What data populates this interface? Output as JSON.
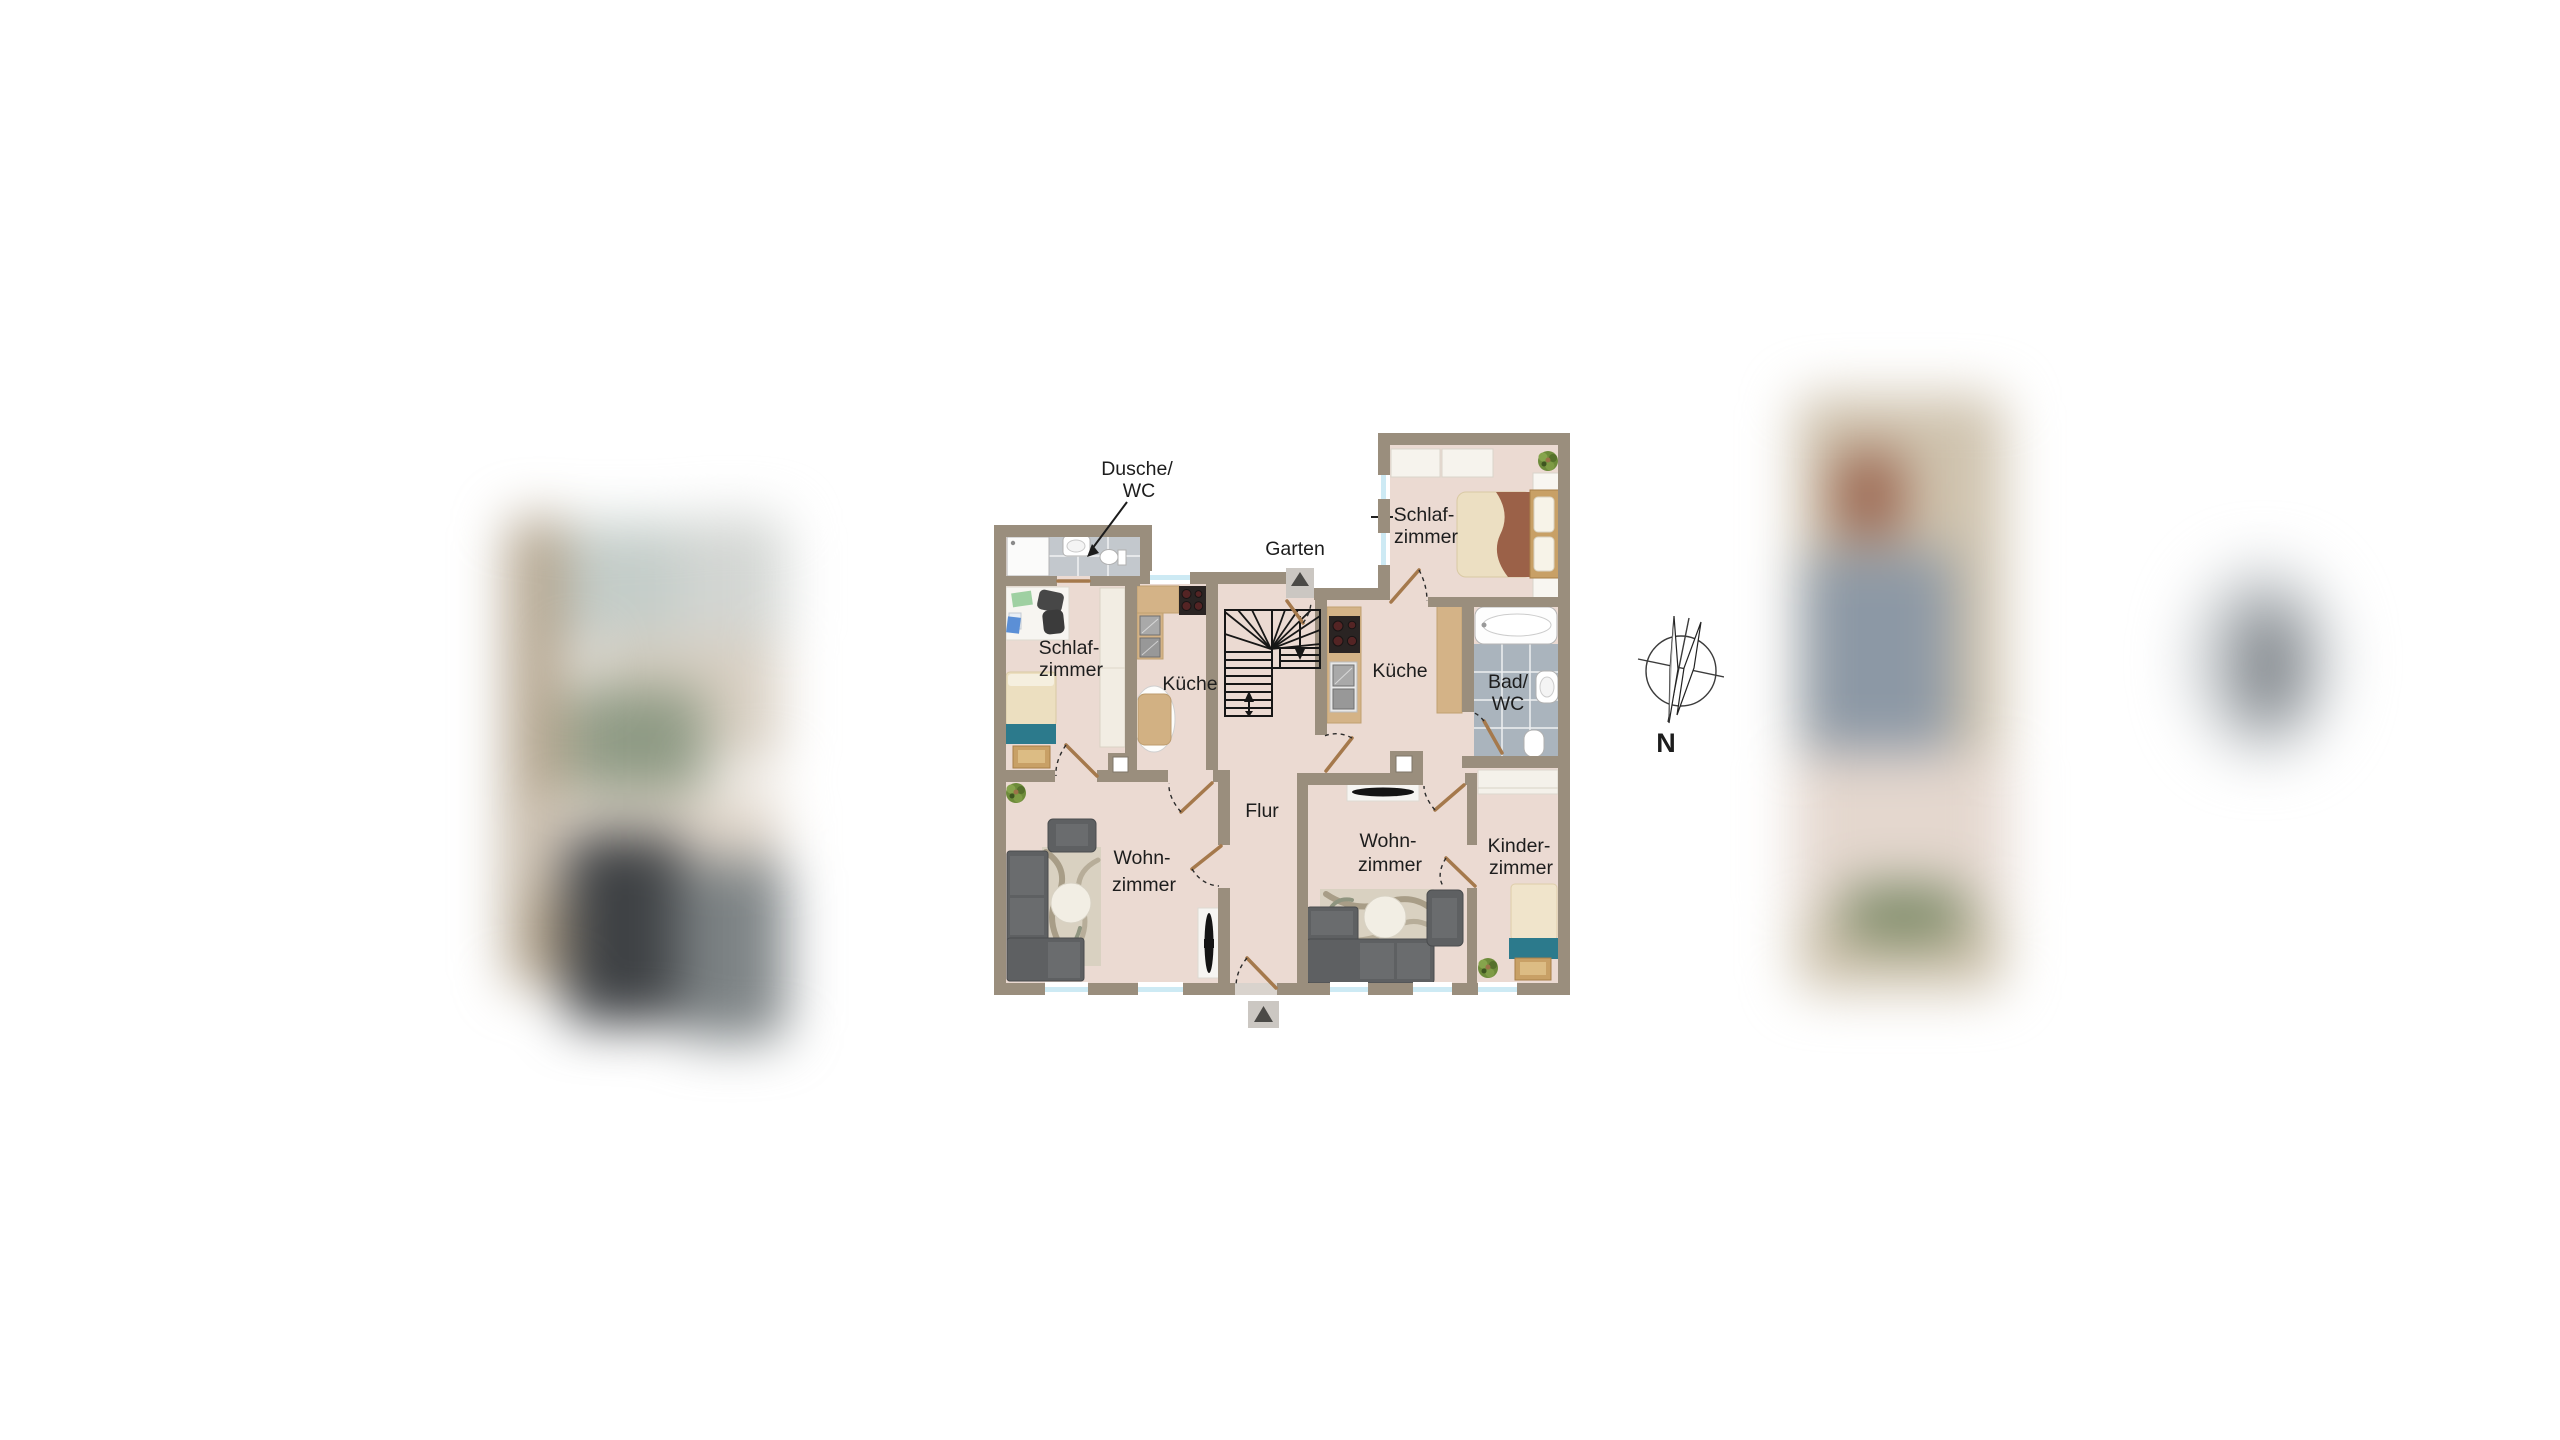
{
  "floorplan": {
    "garten_label": "Garten",
    "compass_label": "N",
    "rooms": {
      "dusche_wc": {
        "line1": "Dusche/",
        "line2": "WC"
      },
      "schlafzimmer_left": {
        "line1": "Schlaf-",
        "line2": "zimmer"
      },
      "schlafzimmer_right": {
        "line1": "Schlaf-",
        "line2": "zimmer"
      },
      "kueche_left": {
        "label": "Küche"
      },
      "kueche_right": {
        "label": "Küche"
      },
      "bad_wc": {
        "line1": "Bad/",
        "line2": "WC"
      },
      "flur": {
        "label": "Flur"
      },
      "wohnzimmer_left": {
        "line1": "Wohn-",
        "line2": "zimmer"
      },
      "wohnzimmer_right": {
        "line1": "Wohn-",
        "line2": "zimmer"
      },
      "kinderzimmer": {
        "line1": "Kinder-",
        "line2": "zimmer"
      }
    },
    "colors": {
      "wall": "#9a8e7d",
      "floor": "#ebdad2",
      "counter": "#d4b387",
      "bath_tile": "#aab4bd",
      "shower_tile": "#c3c8cd",
      "sofa": "#5e6062",
      "teal_blanket": "#2c7a8c",
      "wood": "#c8a066",
      "window_glass": "#cdeaf4",
      "door_leaf": "#a5794c"
    }
  }
}
